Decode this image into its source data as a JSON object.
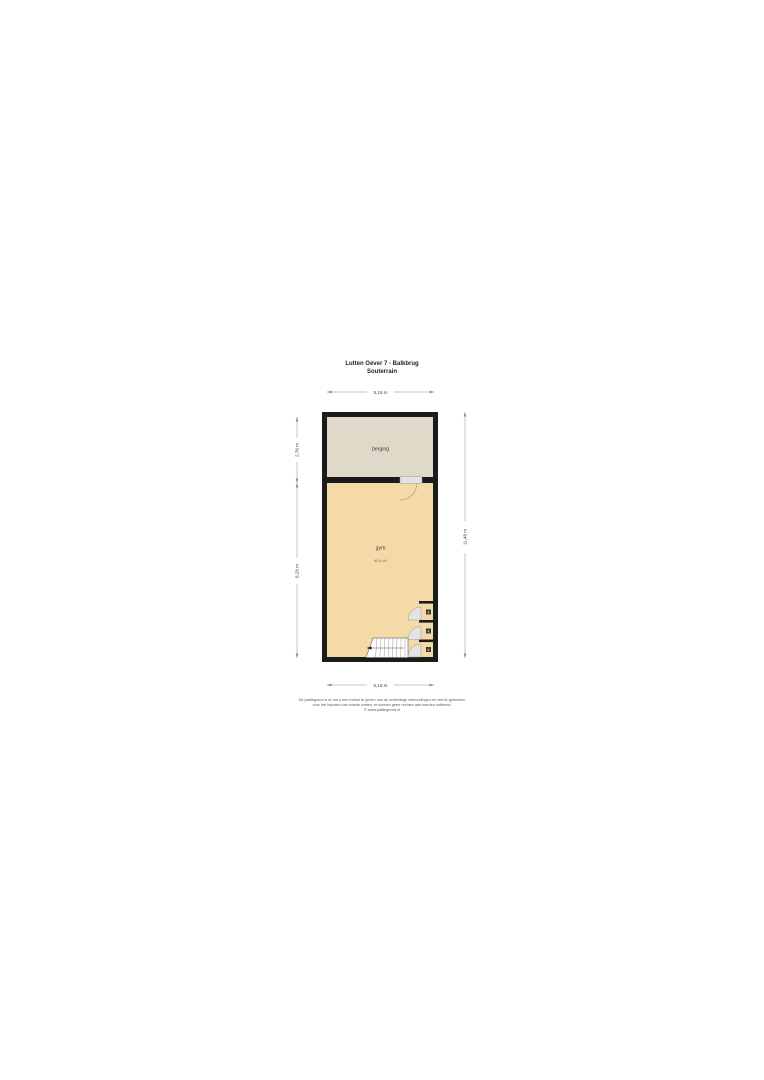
{
  "title": {
    "line1": "Lutten Oever 7 - Balkbrug",
    "line2": "Souterrain"
  },
  "plan": {
    "rooms": {
      "berging": {
        "label": "berging"
      },
      "gym": {
        "label": "gym",
        "area": "40,4 m²"
      }
    },
    "closet_labels": [
      "k",
      "k",
      "k"
    ]
  },
  "dimensions": {
    "top": "5,16 m",
    "bottom": "5,16 m",
    "left_upper": "2,76 m",
    "left_lower": "8,28 m",
    "right": "11,48 m"
  },
  "footer": {
    "line1": "De plattegrond is er om u een indruk te geven van de onderlinge verhoudingen en niet te gebruiken",
    "line2": "voor het bepalen van exacte maten; er kunnen geen rechten aan worden ontleend.",
    "line3": "© www.plattegrond.nl"
  },
  "colors": {
    "wall": "#1b1b1b",
    "berging_fill": "#ded9c8",
    "gym_fill": "#f4daa6",
    "dimension_line": "#8c8c8c",
    "door": "#e3e3e3",
    "stair_fill": "#ffffff",
    "closet_tag": "#3a3a3a"
  }
}
